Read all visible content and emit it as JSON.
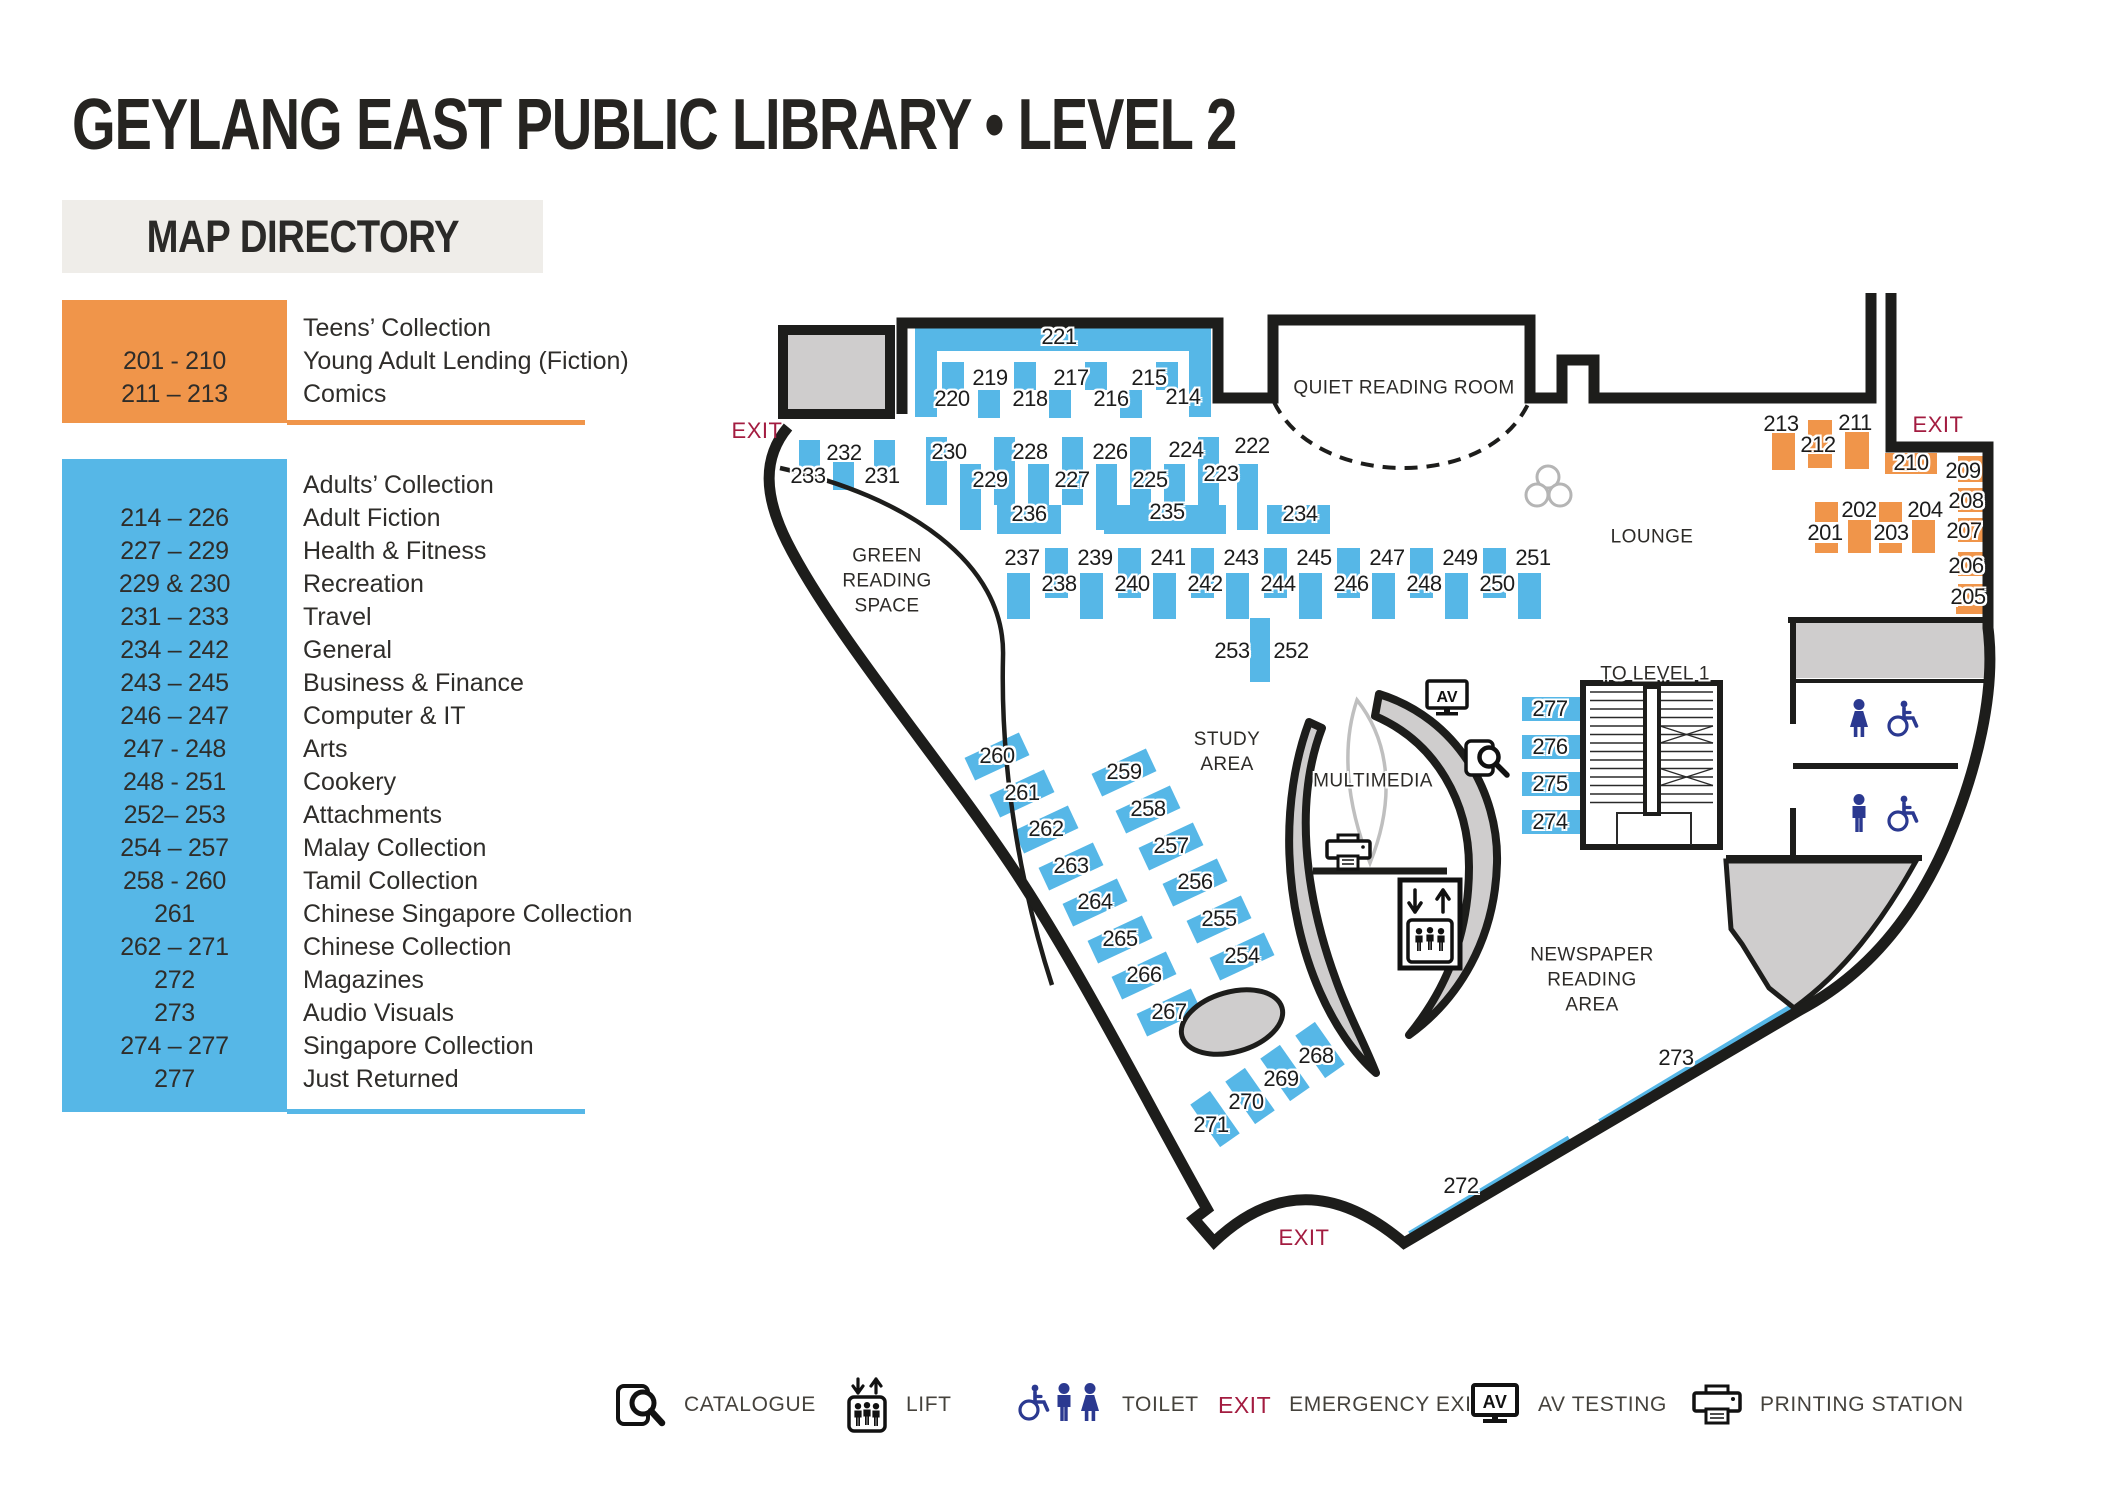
{
  "title": "GEYLANG EAST PUBLIC LIBRARY  •  LEVEL 2",
  "directory": {
    "header": "MAP DIRECTORY",
    "sections": [
      {
        "name": "teens",
        "rows": [
          {
            "num": "",
            "label": "Teens’ Collection"
          },
          {
            "num": "201 - 210",
            "label": "Young Adult Lending (Fiction)"
          },
          {
            "num": "211 – 213",
            "label": "Comics"
          }
        ]
      },
      {
        "name": "adults",
        "rows": [
          {
            "num": "",
            "label": "Adults’ Collection"
          },
          {
            "num": "214 – 226",
            "label": "Adult Fiction"
          },
          {
            "num": "227 – 229",
            "label": "Health & Fitness"
          },
          {
            "num": "229 & 230",
            "label": "Recreation"
          },
          {
            "num": "231 – 233",
            "label": "Travel"
          },
          {
            "num": "234 – 242",
            "label": "General"
          },
          {
            "num": "243 – 245",
            "label": "Business & Finance"
          },
          {
            "num": "246 – 247",
            "label": "Computer & IT"
          },
          {
            "num": "247 - 248",
            "label": "Arts"
          },
          {
            "num": "248 - 251",
            "label": "Cookery"
          },
          {
            "num": "252– 253",
            "label": "Attachments"
          },
          {
            "num": "254 – 257",
            "label": "Malay Collection"
          },
          {
            "num": "258 - 260",
            "label": "Tamil Collection"
          },
          {
            "num": "261",
            "label": "Chinese Singapore Collection"
          },
          {
            "num": "262 – 271",
            "label": "Chinese Collection"
          },
          {
            "num": "272",
            "label": "Magazines"
          },
          {
            "num": "273",
            "label": "Audio Visuals"
          },
          {
            "num": "274 – 277",
            "label": "Singapore Collection"
          },
          {
            "num": "277",
            "label": "Just Returned"
          }
        ]
      }
    ]
  },
  "map": {
    "rooms": {
      "qrr": "QUIET READING ROOM",
      "lounge": "LOUNGE",
      "green": "GREEN\nREADING\nSPACE",
      "study": "STUDY\nAREA",
      "multimedia": "MULTIMEDIA",
      "newspaper": "NEWSPAPER\nREADING\nAREA",
      "to_level_1": "TO LEVEL 1"
    },
    "exits": [
      {
        "t": "EXIT",
        "x": 757,
        "y": 431
      },
      {
        "t": "EXIT",
        "x": 1938,
        "y": 425
      },
      {
        "t": "EXIT",
        "x": 1304,
        "y": 1238
      }
    ],
    "labels": [
      {
        "t": "221",
        "x": 1059,
        "y": 337
      },
      {
        "t": "220",
        "x": 952,
        "y": 399
      },
      {
        "t": "219",
        "x": 990,
        "y": 378
      },
      {
        "t": "218",
        "x": 1030,
        "y": 399
      },
      {
        "t": "217",
        "x": 1071,
        "y": 378
      },
      {
        "t": "216",
        "x": 1111,
        "y": 399
      },
      {
        "t": "215",
        "x": 1149,
        "y": 378
      },
      {
        "t": "214",
        "x": 1183,
        "y": 397
      },
      {
        "t": "233",
        "x": 808,
        "y": 476
      },
      {
        "t": "232",
        "x": 844,
        "y": 453
      },
      {
        "t": "231",
        "x": 882,
        "y": 476
      },
      {
        "t": "230",
        "x": 949,
        "y": 452
      },
      {
        "t": "229",
        "x": 990,
        "y": 480
      },
      {
        "t": "228",
        "x": 1030,
        "y": 452
      },
      {
        "t": "227",
        "x": 1072,
        "y": 480
      },
      {
        "t": "226",
        "x": 1110,
        "y": 452
      },
      {
        "t": "225",
        "x": 1150,
        "y": 480
      },
      {
        "t": "224",
        "x": 1186,
        "y": 450
      },
      {
        "t": "223",
        "x": 1221,
        "y": 474
      },
      {
        "t": "222",
        "x": 1252,
        "y": 446
      },
      {
        "t": "236",
        "x": 1029,
        "y": 514
      },
      {
        "t": "235",
        "x": 1167,
        "y": 512
      },
      {
        "t": "234",
        "x": 1300,
        "y": 514
      },
      {
        "t": "237",
        "x": 1022,
        "y": 558
      },
      {
        "t": "239",
        "x": 1095,
        "y": 558
      },
      {
        "t": "241",
        "x": 1168,
        "y": 558
      },
      {
        "t": "243",
        "x": 1241,
        "y": 558
      },
      {
        "t": "245",
        "x": 1314,
        "y": 558
      },
      {
        "t": "247",
        "x": 1387,
        "y": 558
      },
      {
        "t": "249",
        "x": 1460,
        "y": 558
      },
      {
        "t": "251",
        "x": 1533,
        "y": 558
      },
      {
        "t": "238",
        "x": 1059,
        "y": 584
      },
      {
        "t": "240",
        "x": 1132,
        "y": 584
      },
      {
        "t": "242",
        "x": 1205,
        "y": 584
      },
      {
        "t": "244",
        "x": 1278,
        "y": 584
      },
      {
        "t": "246",
        "x": 1351,
        "y": 584
      },
      {
        "t": "248",
        "x": 1424,
        "y": 584
      },
      {
        "t": "250",
        "x": 1497,
        "y": 584
      },
      {
        "t": "253",
        "x": 1232,
        "y": 651
      },
      {
        "t": "252",
        "x": 1291,
        "y": 651
      },
      {
        "t": "260",
        "x": 997,
        "y": 756
      },
      {
        "t": "261",
        "x": 1022,
        "y": 793
      },
      {
        "t": "262",
        "x": 1046,
        "y": 829
      },
      {
        "t": "263",
        "x": 1071,
        "y": 866
      },
      {
        "t": "264",
        "x": 1095,
        "y": 902
      },
      {
        "t": "265",
        "x": 1120,
        "y": 939
      },
      {
        "t": "266",
        "x": 1144,
        "y": 975
      },
      {
        "t": "267",
        "x": 1169,
        "y": 1012
      },
      {
        "t": "259",
        "x": 1124,
        "y": 772
      },
      {
        "t": "258",
        "x": 1148,
        "y": 809
      },
      {
        "t": "257",
        "x": 1171,
        "y": 846
      },
      {
        "t": "256",
        "x": 1195,
        "y": 882
      },
      {
        "t": "255",
        "x": 1219,
        "y": 919
      },
      {
        "t": "254",
        "x": 1242,
        "y": 956
      },
      {
        "t": "268",
        "x": 1316,
        "y": 1056
      },
      {
        "t": "269",
        "x": 1281,
        "y": 1079
      },
      {
        "t": "270",
        "x": 1246,
        "y": 1102
      },
      {
        "t": "271",
        "x": 1211,
        "y": 1125
      },
      {
        "t": "277",
        "x": 1550,
        "y": 709
      },
      {
        "t": "276",
        "x": 1550,
        "y": 747
      },
      {
        "t": "275",
        "x": 1550,
        "y": 784
      },
      {
        "t": "274",
        "x": 1550,
        "y": 822
      },
      {
        "t": "273",
        "x": 1676,
        "y": 1058
      },
      {
        "t": "272",
        "x": 1461,
        "y": 1186
      },
      {
        "t": "213",
        "x": 1781,
        "y": 424
      },
      {
        "t": "212",
        "x": 1818,
        "y": 445
      },
      {
        "t": "211",
        "x": 1855,
        "y": 423
      },
      {
        "t": "210",
        "x": 1911,
        "y": 463
      },
      {
        "t": "209",
        "x": 1963,
        "y": 471
      },
      {
        "t": "208",
        "x": 1966,
        "y": 501
      },
      {
        "t": "207",
        "x": 1964,
        "y": 531
      },
      {
        "t": "206",
        "x": 1966,
        "y": 566
      },
      {
        "t": "205",
        "x": 1968,
        "y": 597
      },
      {
        "t": "201",
        "x": 1825,
        "y": 533
      },
      {
        "t": "202",
        "x": 1859,
        "y": 510
      },
      {
        "t": "203",
        "x": 1891,
        "y": 533
      },
      {
        "t": "204",
        "x": 1925,
        "y": 510
      }
    ],
    "bars": [
      {
        "x": 915,
        "y": 328,
        "w": 296,
        "h": 23,
        "cls": "b"
      },
      {
        "x": 915,
        "y": 351,
        "w": 22,
        "h": 66,
        "cls": "b"
      },
      {
        "x": 1189,
        "y": 351,
        "w": 22,
        "h": 66,
        "cls": "b"
      },
      {
        "x": 942,
        "y": 362,
        "w": 22,
        "h": 28,
        "cls": "b"
      },
      {
        "x": 1014,
        "y": 362,
        "w": 22,
        "h": 28,
        "cls": "b"
      },
      {
        "x": 1085,
        "y": 362,
        "w": 22,
        "h": 28,
        "cls": "b"
      },
      {
        "x": 1156,
        "y": 362,
        "w": 22,
        "h": 28,
        "cls": "b"
      },
      {
        "x": 978,
        "y": 390,
        "w": 22,
        "h": 28,
        "cls": "b"
      },
      {
        "x": 1049,
        "y": 390,
        "w": 22,
        "h": 28,
        "cls": "b"
      },
      {
        "x": 1120,
        "y": 390,
        "w": 22,
        "h": 28,
        "cls": "b"
      },
      {
        "x": 799,
        "y": 440,
        "w": 21,
        "h": 28,
        "cls": "b"
      },
      {
        "x": 833,
        "y": 462,
        "w": 21,
        "h": 28,
        "cls": "b"
      },
      {
        "x": 874,
        "y": 440,
        "w": 21,
        "h": 28,
        "cls": "b"
      },
      {
        "x": 926,
        "y": 437,
        "w": 21,
        "h": 68,
        "cls": "b"
      },
      {
        "x": 994,
        "y": 437,
        "w": 21,
        "h": 68,
        "cls": "b"
      },
      {
        "x": 1062,
        "y": 437,
        "w": 21,
        "h": 68,
        "cls": "b"
      },
      {
        "x": 1130,
        "y": 437,
        "w": 21,
        "h": 68,
        "cls": "b"
      },
      {
        "x": 1198,
        "y": 437,
        "w": 21,
        "h": 68,
        "cls": "b"
      },
      {
        "x": 960,
        "y": 464,
        "w": 21,
        "h": 66,
        "cls": "b"
      },
      {
        "x": 1028,
        "y": 464,
        "w": 21,
        "h": 66,
        "cls": "b"
      },
      {
        "x": 1096,
        "y": 464,
        "w": 21,
        "h": 66,
        "cls": "b"
      },
      {
        "x": 1164,
        "y": 464,
        "w": 21,
        "h": 66,
        "cls": "b"
      },
      {
        "x": 1237,
        "y": 464,
        "w": 21,
        "h": 66,
        "cls": "b"
      },
      {
        "x": 997,
        "y": 505,
        "w": 64,
        "h": 29,
        "cls": "b"
      },
      {
        "x": 1104,
        "y": 505,
        "w": 122,
        "h": 29,
        "cls": "b"
      },
      {
        "x": 1267,
        "y": 505,
        "w": 63,
        "h": 29,
        "cls": "b"
      },
      {
        "x": 1045,
        "y": 548,
        "w": 23,
        "h": 50,
        "cls": "b"
      },
      {
        "x": 1118,
        "y": 548,
        "w": 23,
        "h": 50,
        "cls": "b"
      },
      {
        "x": 1191,
        "y": 548,
        "w": 23,
        "h": 50,
        "cls": "b"
      },
      {
        "x": 1264,
        "y": 548,
        "w": 23,
        "h": 50,
        "cls": "b"
      },
      {
        "x": 1337,
        "y": 548,
        "w": 23,
        "h": 50,
        "cls": "b"
      },
      {
        "x": 1410,
        "y": 548,
        "w": 23,
        "h": 50,
        "cls": "b"
      },
      {
        "x": 1483,
        "y": 548,
        "w": 23,
        "h": 50,
        "cls": "b"
      },
      {
        "x": 1007,
        "y": 573,
        "w": 23,
        "h": 46,
        "cls": "b"
      },
      {
        "x": 1080,
        "y": 573,
        "w": 23,
        "h": 46,
        "cls": "b"
      },
      {
        "x": 1153,
        "y": 573,
        "w": 23,
        "h": 46,
        "cls": "b"
      },
      {
        "x": 1226,
        "y": 573,
        "w": 23,
        "h": 46,
        "cls": "b"
      },
      {
        "x": 1299,
        "y": 573,
        "w": 23,
        "h": 46,
        "cls": "b"
      },
      {
        "x": 1372,
        "y": 573,
        "w": 23,
        "h": 46,
        "cls": "b"
      },
      {
        "x": 1445,
        "y": 573,
        "w": 23,
        "h": 46,
        "cls": "b"
      },
      {
        "x": 1518,
        "y": 573,
        "w": 23,
        "h": 46,
        "cls": "b"
      },
      {
        "x": 1250,
        "y": 618,
        "w": 20,
        "h": 64,
        "cls": "b"
      },
      {
        "x": 1522,
        "y": 697,
        "w": 62,
        "h": 24,
        "cls": "b"
      },
      {
        "x": 1522,
        "y": 735,
        "w": 62,
        "h": 24,
        "cls": "b"
      },
      {
        "x": 1522,
        "y": 772,
        "w": 62,
        "h": 24,
        "cls": "b"
      },
      {
        "x": 1522,
        "y": 810,
        "w": 62,
        "h": 24,
        "cls": "b"
      },
      {
        "x": 967,
        "y": 744,
        "w": 60,
        "h": 25,
        "r": -25,
        "cls": "b"
      },
      {
        "x": 992,
        "y": 781,
        "w": 60,
        "h": 25,
        "r": -25,
        "cls": "b"
      },
      {
        "x": 1016,
        "y": 817,
        "w": 60,
        "h": 25,
        "r": -25,
        "cls": "b"
      },
      {
        "x": 1041,
        "y": 854,
        "w": 60,
        "h": 25,
        "r": -25,
        "cls": "b"
      },
      {
        "x": 1065,
        "y": 890,
        "w": 60,
        "h": 25,
        "r": -25,
        "cls": "b"
      },
      {
        "x": 1090,
        "y": 927,
        "w": 60,
        "h": 25,
        "r": -25,
        "cls": "b"
      },
      {
        "x": 1114,
        "y": 963,
        "w": 60,
        "h": 25,
        "r": -25,
        "cls": "b"
      },
      {
        "x": 1139,
        "y": 1000,
        "w": 60,
        "h": 25,
        "r": -25,
        "cls": "b"
      },
      {
        "x": 1094,
        "y": 760,
        "w": 60,
        "h": 25,
        "r": -25,
        "cls": "b"
      },
      {
        "x": 1118,
        "y": 797,
        "w": 60,
        "h": 25,
        "r": -25,
        "cls": "b"
      },
      {
        "x": 1141,
        "y": 834,
        "w": 60,
        "h": 25,
        "r": -25,
        "cls": "b"
      },
      {
        "x": 1165,
        "y": 870,
        "w": 60,
        "h": 25,
        "r": -25,
        "cls": "b"
      },
      {
        "x": 1189,
        "y": 907,
        "w": 60,
        "h": 25,
        "r": -25,
        "cls": "b"
      },
      {
        "x": 1212,
        "y": 944,
        "w": 60,
        "h": 25,
        "r": -25,
        "cls": "b"
      },
      {
        "x": 1308,
        "y": 1024,
        "w": 24,
        "h": 52,
        "r": -35,
        "cls": "b"
      },
      {
        "x": 1273,
        "y": 1047,
        "w": 24,
        "h": 52,
        "r": -35,
        "cls": "b"
      },
      {
        "x": 1238,
        "y": 1070,
        "w": 24,
        "h": 52,
        "r": -35,
        "cls": "b"
      },
      {
        "x": 1203,
        "y": 1093,
        "w": 24,
        "h": 52,
        "r": -35,
        "cls": "b"
      },
      {
        "x": 1410,
        "y": 1231,
        "w": 186,
        "h": 7,
        "r": -31,
        "o": "0 50%",
        "cls": "b"
      },
      {
        "x": 1600,
        "y": 1119,
        "w": 226,
        "h": 7,
        "r": -31,
        "o": "0 50%",
        "cls": "b"
      },
      {
        "x": 1772,
        "y": 433,
        "w": 23,
        "h": 37,
        "cls": "o"
      },
      {
        "x": 1808,
        "y": 420,
        "w": 24,
        "h": 48,
        "cls": "o"
      },
      {
        "x": 1845,
        "y": 431,
        "w": 24,
        "h": 38,
        "cls": "o"
      },
      {
        "x": 1885,
        "y": 453,
        "w": 52,
        "h": 21,
        "cls": "o"
      },
      {
        "x": 1958,
        "y": 456,
        "w": 28,
        "h": 26,
        "cls": "o"
      },
      {
        "x": 1958,
        "y": 488,
        "w": 28,
        "h": 24,
        "cls": "o"
      },
      {
        "x": 1958,
        "y": 518,
        "w": 28,
        "h": 24,
        "cls": "o"
      },
      {
        "x": 1958,
        "y": 552,
        "w": 28,
        "h": 24,
        "cls": "o"
      },
      {
        "x": 1958,
        "y": 584,
        "w": 28,
        "h": 24,
        "cls": "o"
      },
      {
        "x": 1956,
        "y": 607,
        "w": 30,
        "h": 7,
        "cls": "o"
      },
      {
        "x": 1815,
        "y": 502,
        "w": 23,
        "h": 20,
        "cls": "o"
      },
      {
        "x": 1815,
        "y": 543,
        "w": 23,
        "h": 10,
        "cls": "o"
      },
      {
        "x": 1848,
        "y": 520,
        "w": 23,
        "h": 33,
        "cls": "o"
      },
      {
        "x": 1879,
        "y": 502,
        "w": 23,
        "h": 20,
        "cls": "o"
      },
      {
        "x": 1879,
        "y": 543,
        "w": 23,
        "h": 10,
        "cls": "o"
      },
      {
        "x": 1912,
        "y": 520,
        "w": 23,
        "h": 33,
        "cls": "o"
      }
    ]
  },
  "legend": {
    "catalogue": "CATALOGUE",
    "lift": "LIFT",
    "toilet": "TOILET",
    "exit_word": "EXIT",
    "emergency": "EMERGENCY EXIT",
    "av": "AV TESTING",
    "printing": "PRINTING STATION"
  },
  "colors": {
    "blue": "#56B7E7",
    "orange": "#F0954A",
    "wall": "#1d1d1b",
    "exit_red": "#A31C40",
    "toilet_navy": "#2B3990",
    "room_gray": "#CFCDCD"
  }
}
